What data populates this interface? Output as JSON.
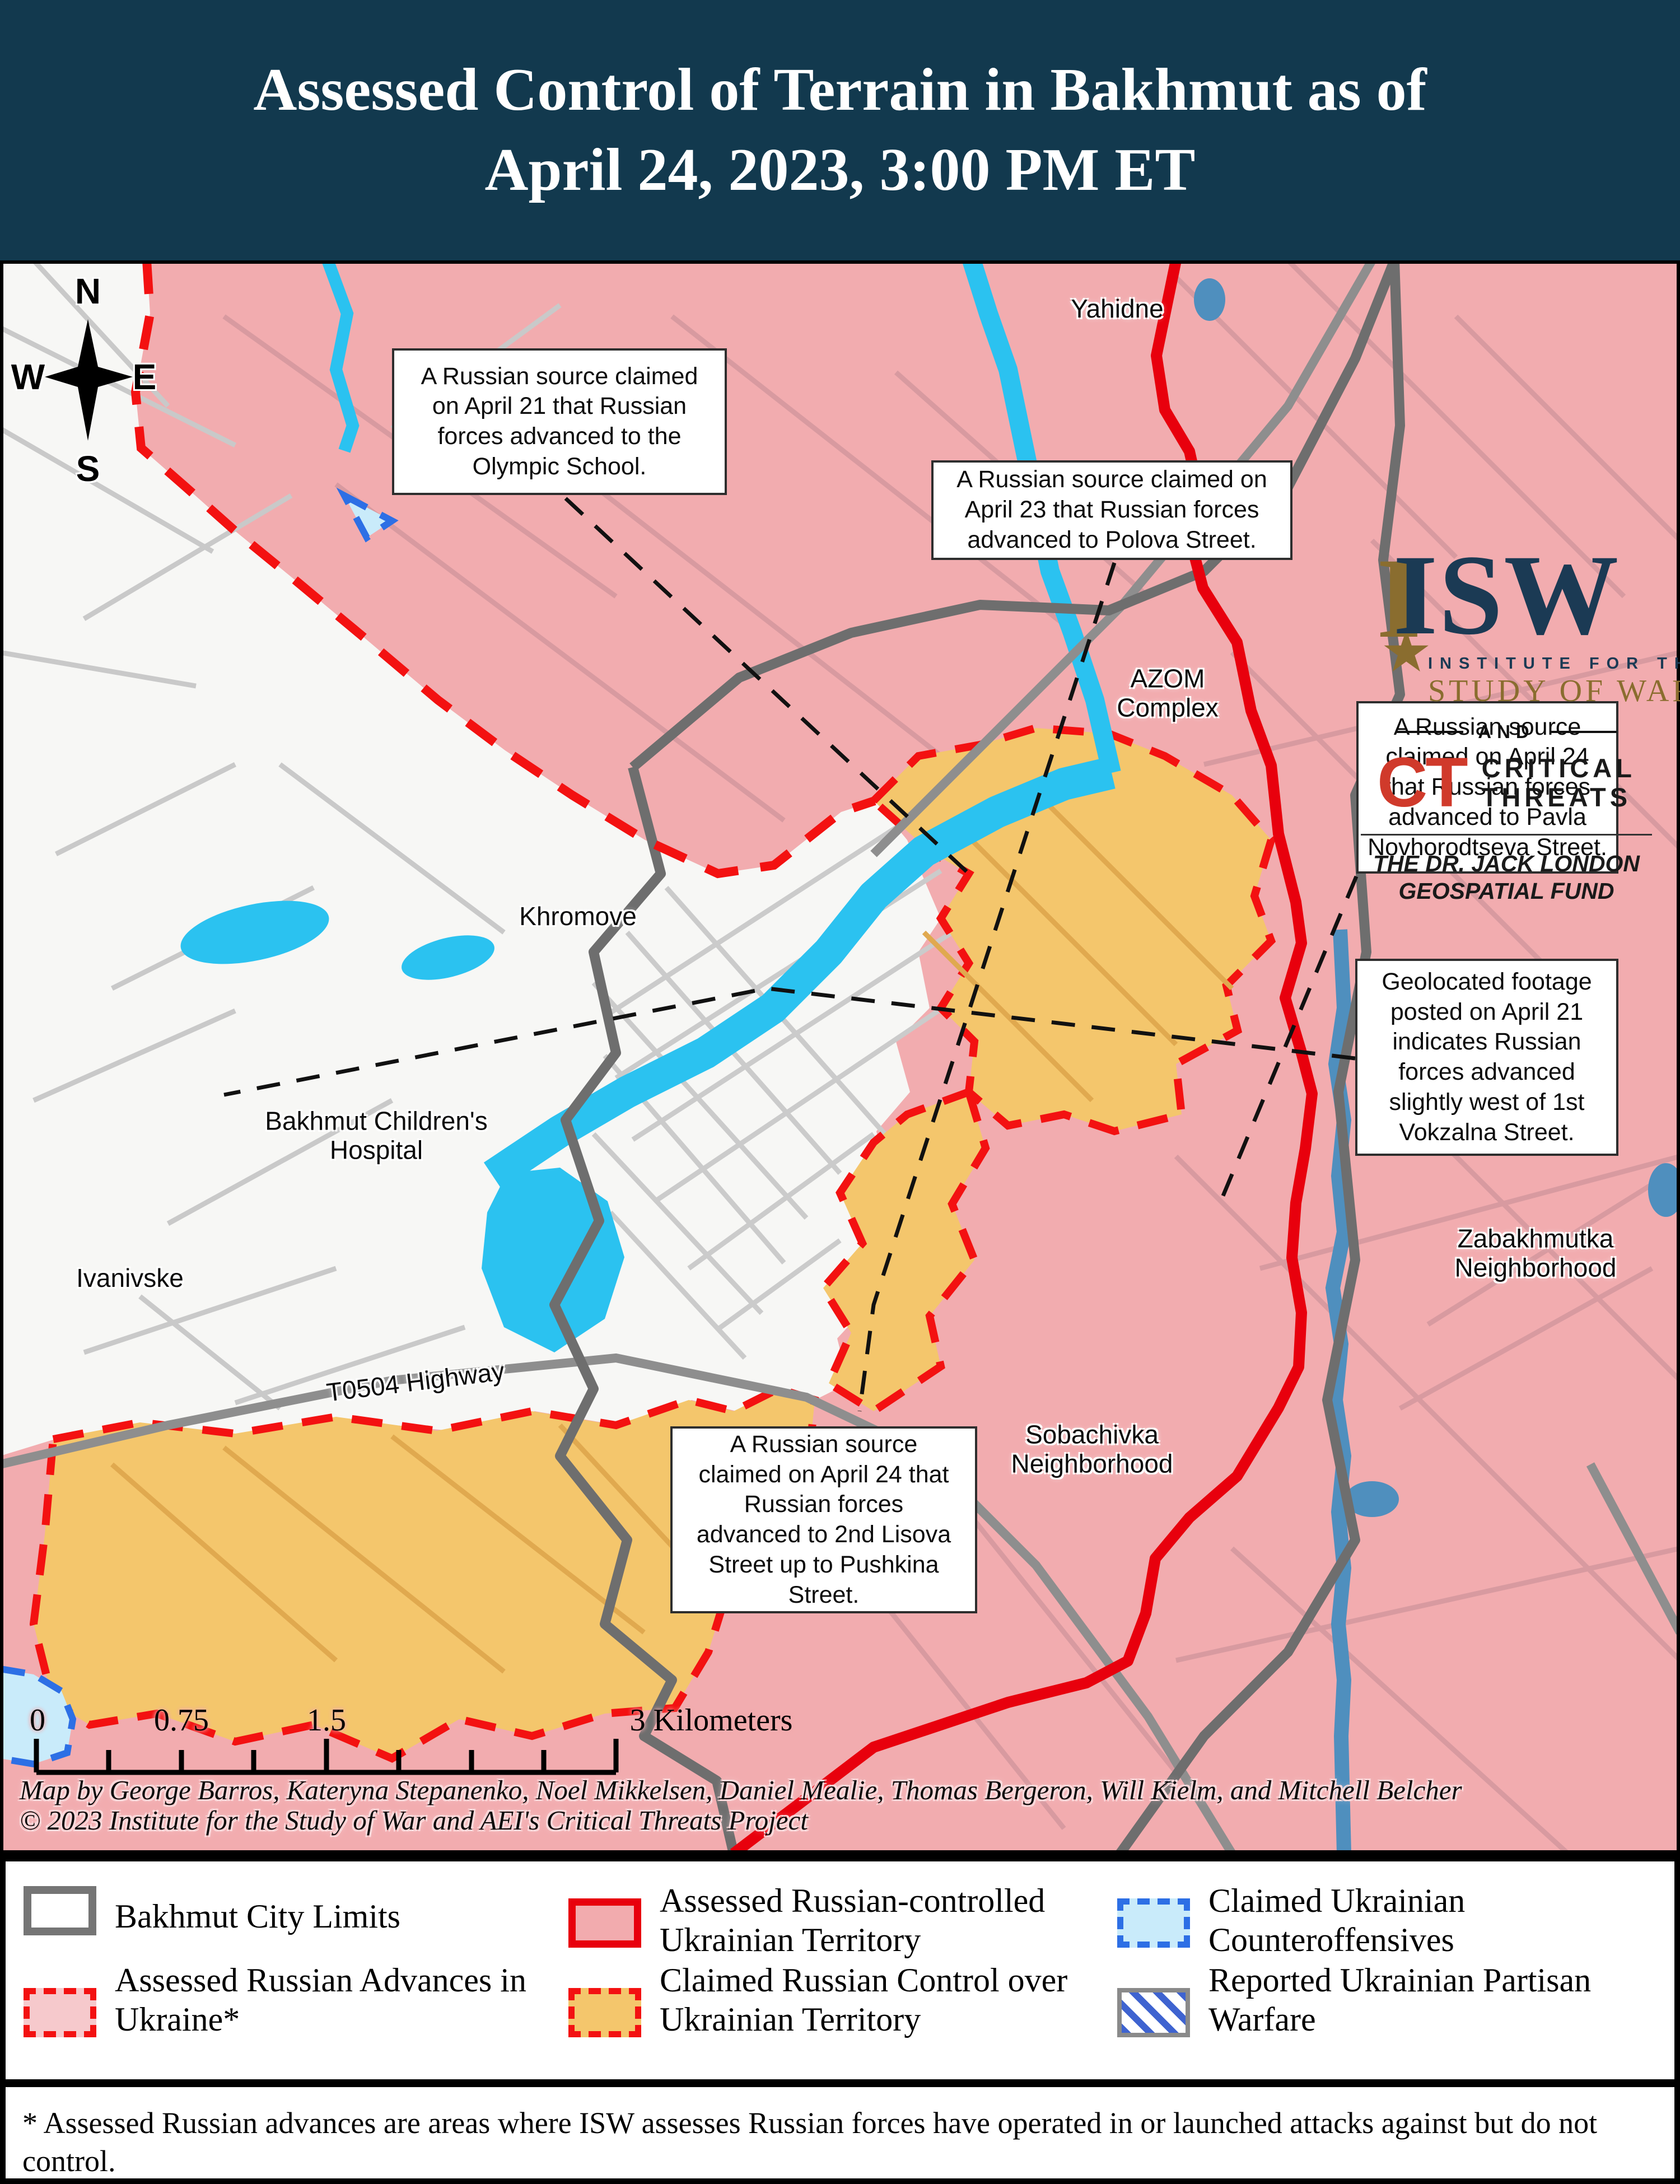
{
  "title": {
    "line1": "Assessed Control of Terrain in Bakhmut as of",
    "line2": "April 24, 2023, 3:00 PM ET"
  },
  "logo": {
    "isw": "ISW",
    "gold_i": "I",
    "star": "★",
    "institute": "INSTITUTE FOR THE",
    "study": "STUDY OF WAR",
    "and": "AND",
    "ct": "CT",
    "ct_text": "CRITICAL\nTHREATS",
    "fund": "THE DR. JACK LONDON\nGEOSPATIAL FUND"
  },
  "compass": {
    "n": "N",
    "e": "E",
    "s": "S",
    "w": "W"
  },
  "map_labels": [
    {
      "id": "yahidne",
      "text": "Yahidne"
    },
    {
      "id": "azom-complex",
      "text": "AZOM\nComplex"
    },
    {
      "id": "khromove",
      "text": "Khromove"
    },
    {
      "id": "bakhmut-childrens-hospital",
      "text": "Bakhmut Children's\nHospital"
    },
    {
      "id": "ivanivske",
      "text": "Ivanivske"
    },
    {
      "id": "t0504-highway",
      "text": "T0504 Highway"
    },
    {
      "id": "sobachivka",
      "text": "Sobachivka\nNeighborhood"
    },
    {
      "id": "zabakhmutka",
      "text": "Zabakhmutka\nNeighborhood"
    }
  ],
  "callouts": [
    {
      "id": "olympic-school",
      "text": "A Russian source claimed\non April 21 that Russian\nforces advanced to the\nOlympic School."
    },
    {
      "id": "polova-street",
      "text": "A Russian source claimed on\nApril 23 that Russian forces\nadvanced to Polova Street."
    },
    {
      "id": "pavla-novhorodtseva-street",
      "text": "A Russian source\nclaimed on April 24\nthat Russian forces\nadvanced to Pavla\nNovhorodtseva Street."
    },
    {
      "id": "vokzalna-street",
      "text": "Geolocated footage\nposted on April 21\nindicates Russian\nforces advanced\nslightly west of 1st\nVokzalna Street."
    },
    {
      "id": "lisova-pushkina-street",
      "text": "A Russian source\nclaimed on April 24 that\nRussian forces\nadvanced to 2nd Lisova\nStreet up to Pushkina\nStreet."
    }
  ],
  "scale_bar": {
    "labels": [
      "0",
      "0.75",
      "1.5",
      "3 Kilometers"
    ]
  },
  "credits": {
    "line1": "Map by George Barros, Kateryna Stepanenko, Noel Mikkelsen, Daniel Mealie, Thomas Bergeron, Will Kielm, and Mitchell Belcher",
    "line2": "© 2023 Institute for the Study of War and AEI's Critical Threats Project"
  },
  "legend": {
    "items": [
      {
        "id": "bakhmut-city-limits",
        "label": "Bakhmut City Limits"
      },
      {
        "id": "assessed-russian-advances",
        "label": "Assessed Russian Advances in\nUkraine*"
      },
      {
        "id": "assessed-russian-controlled",
        "label": "Assessed Russian-controlled\nUkrainian Territory"
      },
      {
        "id": "claimed-russian-control",
        "label": "Claimed Russian Control over\nUkrainian Territory"
      },
      {
        "id": "claimed-ukrainian-counteroffensives",
        "label": "Claimed Ukrainian\nCounteroffensives"
      },
      {
        "id": "reported-ukrainian-partisan-warfare",
        "label": "Reported Ukrainian Partisan\nWarfare"
      }
    ]
  },
  "footnote": {
    "text": "* Assessed Russian advances are areas where ISW assesses Russian forces have operated in or launched attacks against but do not\ncontrol."
  },
  "colors": {
    "title_bg": "#12394E",
    "russian_controlled_fill": "#F2ACAF",
    "claimed_russian_fill": "#F4C66C",
    "ukrainian_counteroffensive_fill": "#C9EBFA",
    "front_line_red": "#E8000D",
    "advance_dash_red": "#F31111",
    "counteroffensive_blue": "#2D6FE5",
    "water_cyan": "#2BC2F0",
    "river_steel_blue": "#4F8FBE",
    "city_limits_gray": "#6E6E6E"
  }
}
